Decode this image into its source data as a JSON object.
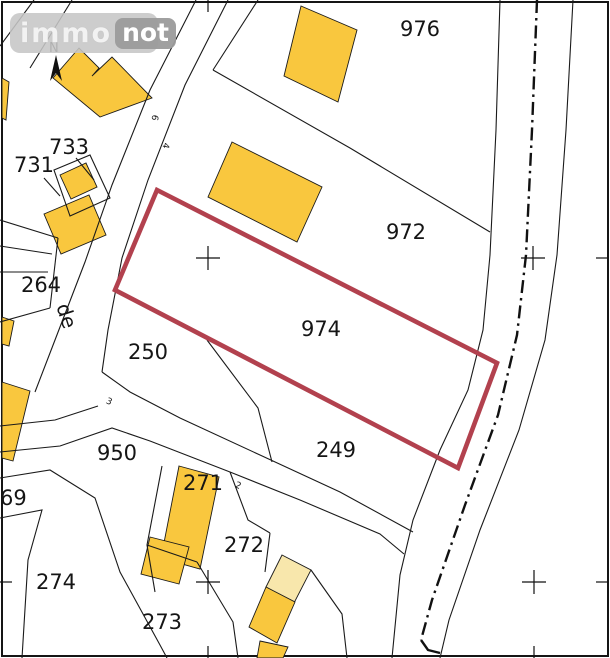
{
  "logo": {
    "part1": "immo",
    "part2": "not"
  },
  "compass": {
    "label": "N"
  },
  "street": {
    "name": "de"
  },
  "road_numbers": {
    "n6": "6",
    "n4": "4",
    "n3": "3",
    "n2": "2"
  },
  "parcels": {
    "p976": "976",
    "p972": "972",
    "p974": "974",
    "p733": "733",
    "p731": "731",
    "p264": "264",
    "p250": "250",
    "p249": "249",
    "p950": "950",
    "p69": "69",
    "p271": "271",
    "p272": "272",
    "p274": "274",
    "p273": "273"
  },
  "colors": {
    "building": "#F9C73E",
    "building_light": "#F8E7AC",
    "highlight": "#B2414E",
    "line": "#1a1a1a"
  }
}
